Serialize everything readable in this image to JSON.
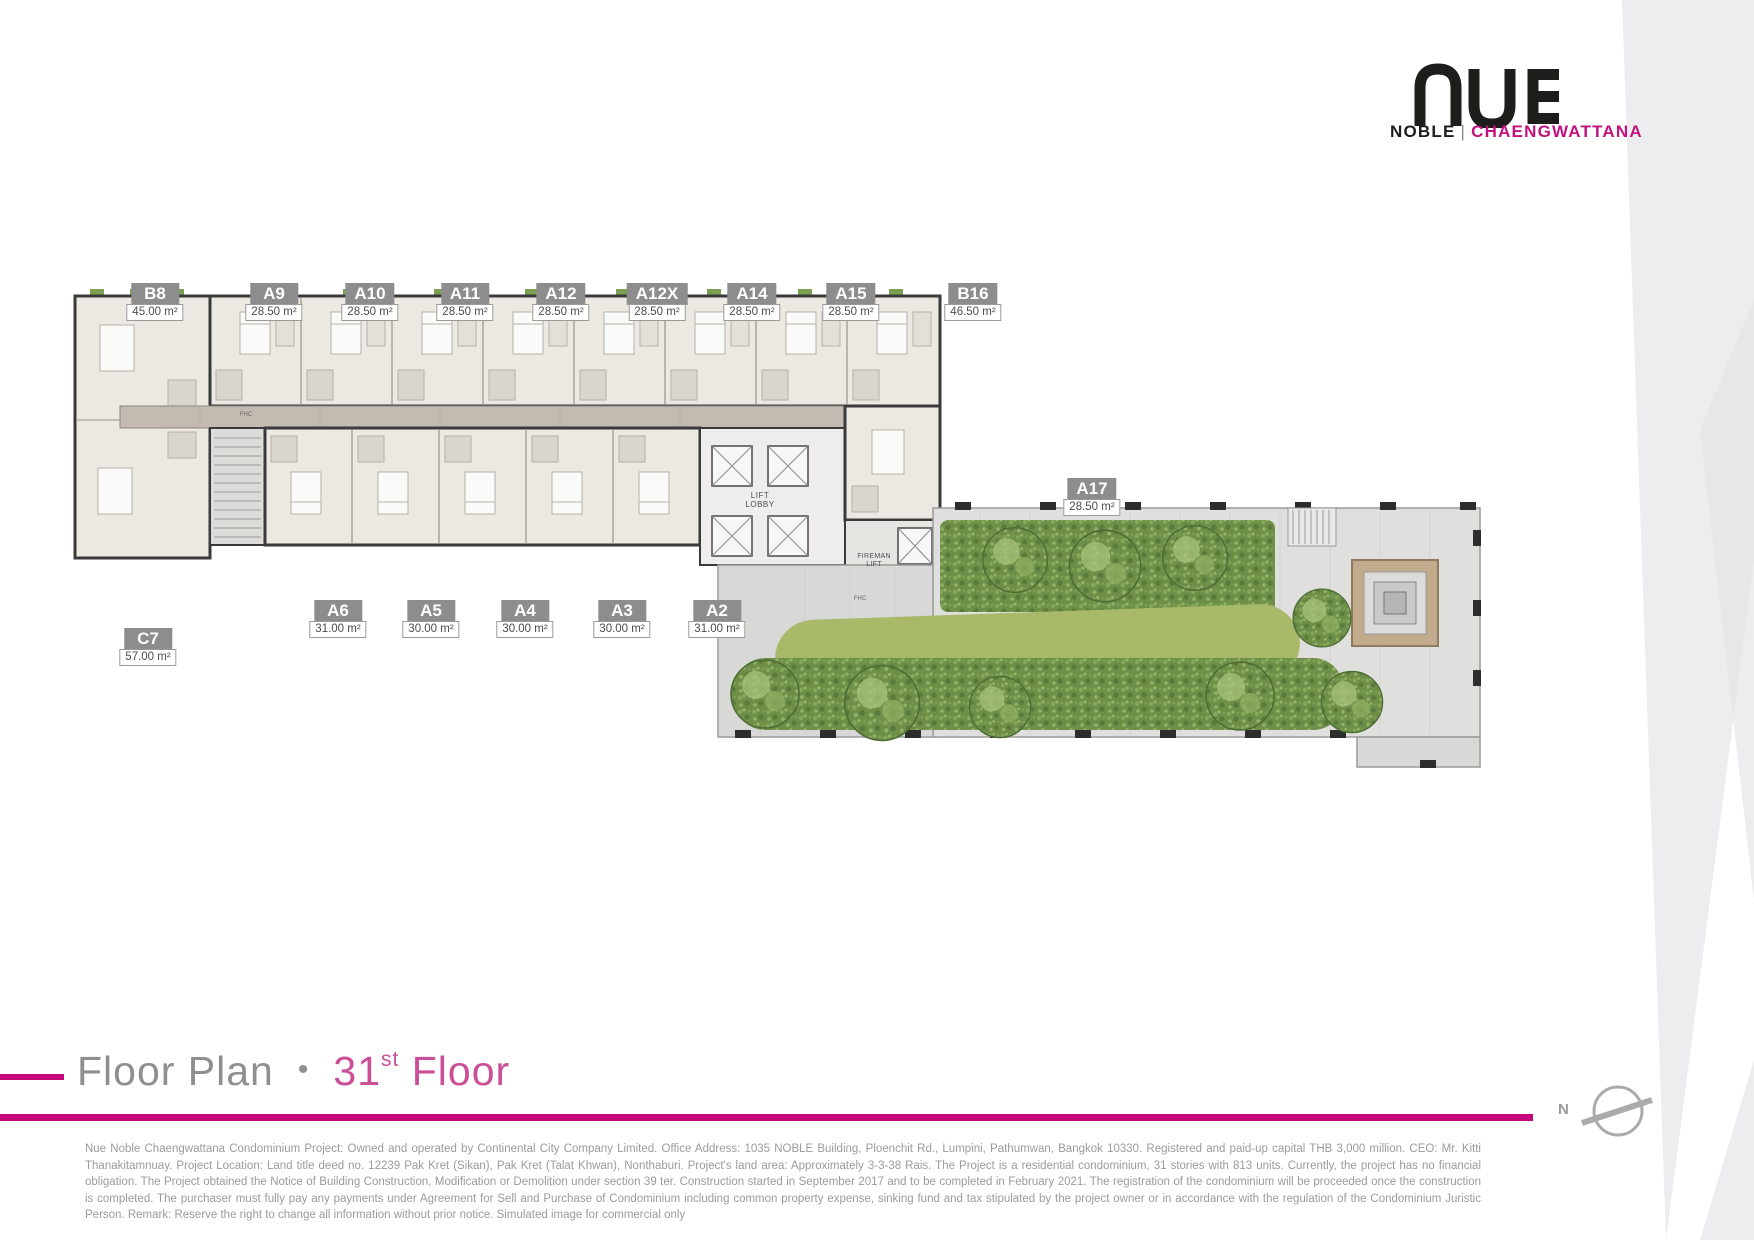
{
  "brand": {
    "logo_text": "NUE",
    "sub_left": "NOBLE",
    "sub_separator": "|",
    "sub_right": "CHAENGWATTANA"
  },
  "colors": {
    "accent_magenta": "#c4087c",
    "brand_pink": "#c3117e",
    "title_pink": "#ca4f96",
    "label_gray": "#8d8d8d",
    "hedge_green": "#6d8f48",
    "lawn_green": "#a8b96a"
  },
  "title": {
    "prefix": "Floor Plan",
    "bullet": "•",
    "floor_number": "31",
    "floor_ordinal": "st",
    "suffix": "Floor"
  },
  "compass": {
    "label": "N"
  },
  "plan": {
    "lift_lobby_label": "LIFT\nLOBBY",
    "fireman_lift_label": "FIREMAN\nLIFT",
    "fhc_label": "FHC",
    "units": [
      {
        "id": "B8",
        "area": "45.00 m²"
      },
      {
        "id": "A9",
        "area": "28.50 m²"
      },
      {
        "id": "A10",
        "area": "28.50 m²"
      },
      {
        "id": "A11",
        "area": "28.50 m²"
      },
      {
        "id": "A12",
        "area": "28.50 m²"
      },
      {
        "id": "A12X",
        "area": "28.50 m²"
      },
      {
        "id": "A14",
        "area": "28.50 m²"
      },
      {
        "id": "A15",
        "area": "28.50 m²"
      },
      {
        "id": "B16",
        "area": "46.50 m²"
      },
      {
        "id": "A17",
        "area": "28.50 m²"
      },
      {
        "id": "A6",
        "area": "31.00 m²"
      },
      {
        "id": "A5",
        "area": "30.00 m²"
      },
      {
        "id": "A4",
        "area": "30.00 m²"
      },
      {
        "id": "A3",
        "area": "30.00 m²"
      },
      {
        "id": "A2",
        "area": "31.00 m²"
      },
      {
        "id": "C7",
        "area": "57.00 m²"
      }
    ]
  },
  "disclaimer": "Nue Noble Chaengwattana Condominium Project: Owned and operated by Continental City Company Limited. Office Address: 1035 NOBLE Building, Ploenchit Rd., Lumpini, Pathumwan, Bangkok 10330. Registered and paid-up capital THB 3,000 million. CEO: Mr. Kitti Thanakitamnuay. Project Location: Land title deed no. 12239 Pak Kret (Sikan), Pak Kret (Talat Khwan), Nonthaburi. Project's land area: Approximately 3-3-38 Rais. The Project is a residential condominium, 31 stories with 813 units. Currently, the project has no financial obligation. The Project obtained the Notice of Building Construction, Modification or Demolition under section 39 ter. Construction started in September 2017 and to be completed in February 2021. The registration of the condominium will be proceeded once the construction is completed. The purchaser must fully pay any payments under Agreement for Sell and Purchase of Condominium including common property expense, sinking fund and tax stipulated by the project owner or in accordance with the regulation of the Condominium Juristic Person. Remark: Reserve the right to change all information without prior notice. Simulated image for commercial only"
}
